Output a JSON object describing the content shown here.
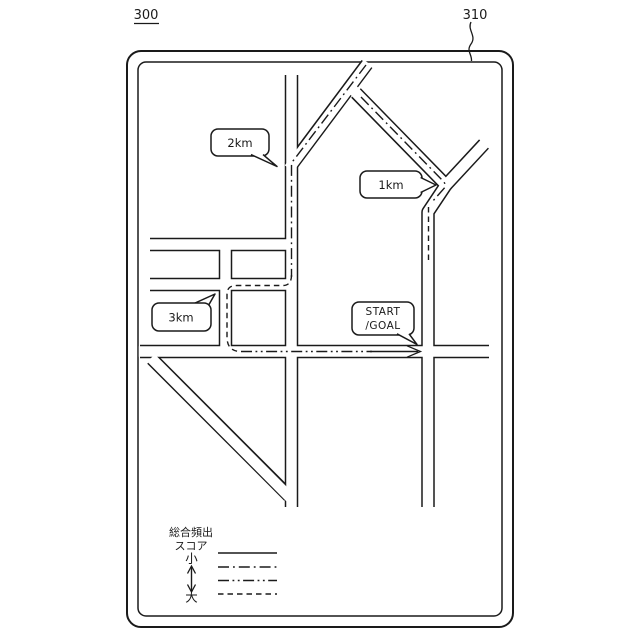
{
  "figure": {
    "figure_ref": "300",
    "screen_ref": "310"
  },
  "map": {
    "distance_labels": {
      "label_2km": "2km",
      "label_1km": "1km",
      "label_3km": "3km"
    },
    "start_goal": {
      "line1": "START",
      "line2": "/GOAL"
    }
  },
  "legend": {
    "title_line1": "総合頻出",
    "title_line2": "スコア",
    "scale_small": "小",
    "scale_large": "大",
    "line_styles": [
      "solid",
      "dash-dot",
      "dash-dot-dot",
      "dashed"
    ]
  },
  "colors": {
    "ink": "#1a1a1a",
    "paper": "#ffffff"
  }
}
